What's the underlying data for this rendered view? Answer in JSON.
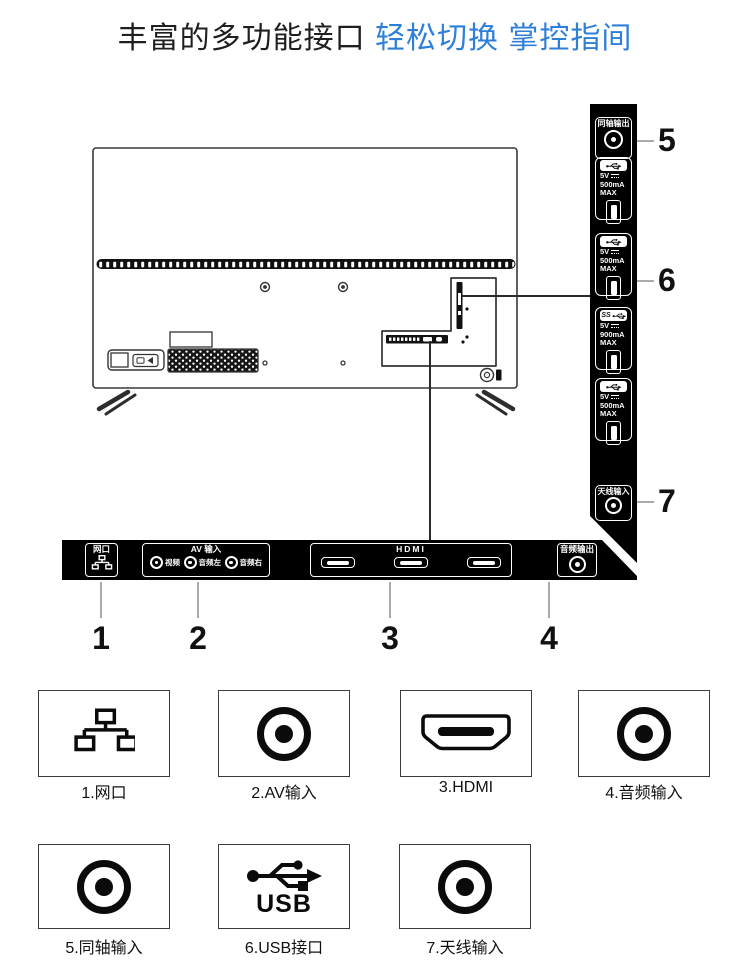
{
  "title": {
    "black": "丰富的多功能接口",
    "blue": "轻松切换 掌控指间",
    "blue_color": "#2e7fd8"
  },
  "side_panel": {
    "coax_label": "同轴输出",
    "antenna_label": "天线输入",
    "ss_label": "SS",
    "usb": [
      {
        "volt": "5V",
        "current": "500mA",
        "max": "MAX",
        "icon": "usb-icon"
      },
      {
        "volt": "5V",
        "current": "500mA",
        "max": "MAX",
        "icon": "usb-icon"
      },
      {
        "volt": "5V",
        "current": "900mA",
        "max": "MAX",
        "icon": "usb3-ss-icon"
      },
      {
        "volt": "5V",
        "current": "500mA",
        "max": "MAX",
        "icon": "usb-icon"
      }
    ]
  },
  "bar": {
    "lan_label": "网口",
    "av_label": "AV 输入",
    "av_ports": [
      {
        "label": "视频"
      },
      {
        "label": "音频左"
      },
      {
        "label": "音频右"
      }
    ],
    "hdmi_label": "HDMI",
    "audio_label": "音频输出"
  },
  "numbers": [
    "1",
    "2",
    "3",
    "4",
    "5",
    "6",
    "7"
  ],
  "legend": [
    {
      "label": "1.网口",
      "icon": "ethernet-icon"
    },
    {
      "label": "2.AV输入",
      "icon": "rca-icon"
    },
    {
      "label": "3.HDMI",
      "icon": "hdmi-icon"
    },
    {
      "label": "4.音频输入",
      "icon": "rca-icon"
    },
    {
      "label": "5.同轴输入",
      "icon": "rca-icon"
    },
    {
      "label": "6.USB接口",
      "icon": "usb-icon"
    },
    {
      "label": "7.天线输入",
      "icon": "rca-icon"
    }
  ],
  "legend_usb_text": "USB"
}
